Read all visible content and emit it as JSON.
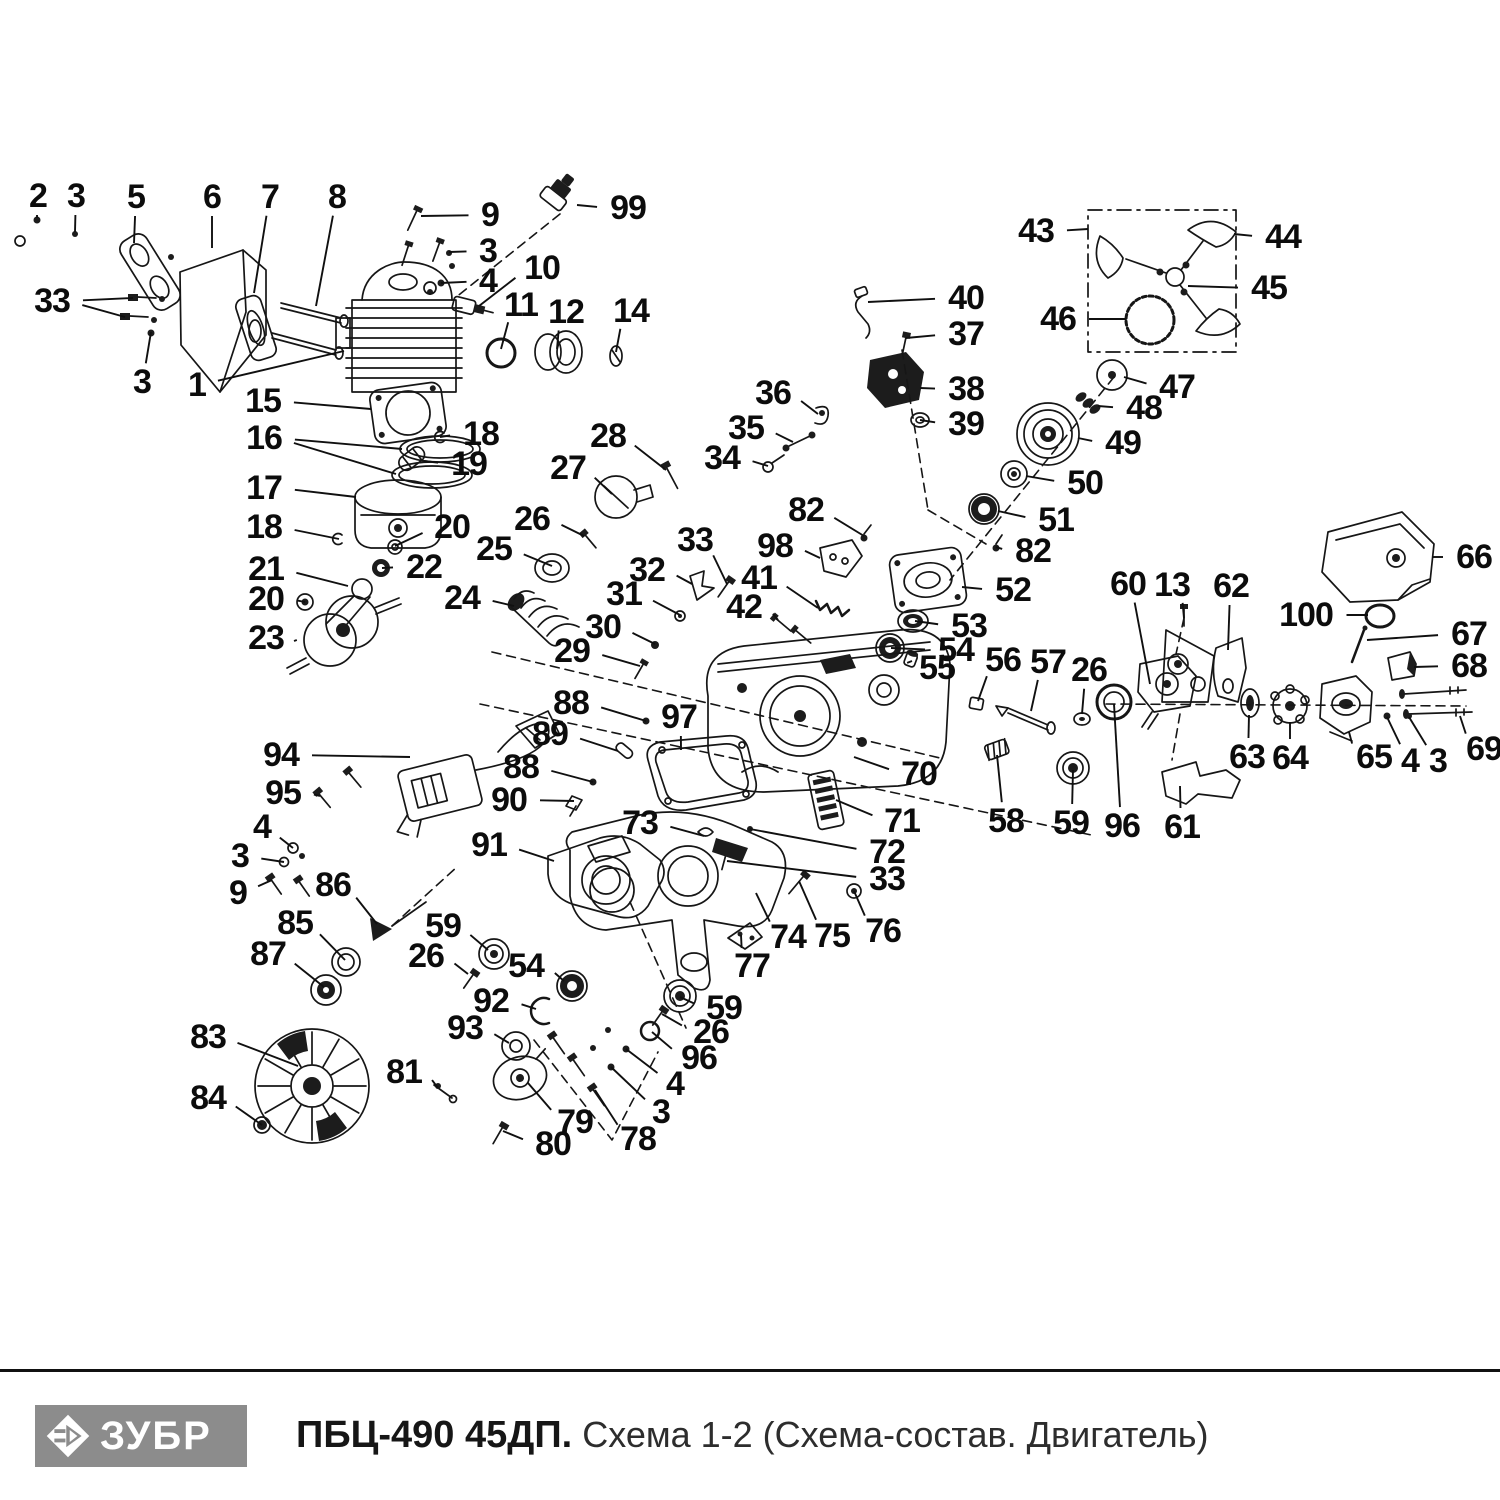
{
  "footer": {
    "brand": "ЗУБР",
    "model": "ПБЦ-490 45ДП.",
    "schema_label": "Схема 1-2 (Схема-состав. Двигатель)"
  },
  "colors": {
    "ink": "#161616",
    "logo_bg": "#8c8c8c",
    "background": "#ffffff"
  },
  "callouts": [
    {
      "n": "2",
      "x": 38,
      "y": 196,
      "t": [
        [
          37,
          218
        ]
      ]
    },
    {
      "n": "3",
      "x": 76,
      "y": 196,
      "t": [
        [
          75,
          232
        ]
      ]
    },
    {
      "n": "5",
      "x": 136,
      "y": 197,
      "t": [
        [
          134,
          243
        ]
      ]
    },
    {
      "n": "6",
      "x": 212,
      "y": 197,
      "t": [
        [
          212,
          248
        ]
      ]
    },
    {
      "n": "7",
      "x": 270,
      "y": 197,
      "t": [
        [
          254,
          293
        ]
      ]
    },
    {
      "n": "8",
      "x": 337,
      "y": 197,
      "t": [
        [
          316,
          306
        ]
      ]
    },
    {
      "n": "9",
      "x": 490,
      "y": 215,
      "t": [
        [
          421,
          216
        ]
      ]
    },
    {
      "n": "99",
      "x": 628,
      "y": 208,
      "t": [
        [
          577,
          205
        ]
      ]
    },
    {
      "n": "3",
      "x": 488,
      "y": 251,
      "t": [
        [
          449,
          252
        ]
      ]
    },
    {
      "n": "4",
      "x": 488,
      "y": 281,
      "t": [
        [
          441,
          283
        ]
      ]
    },
    {
      "n": "10",
      "x": 542,
      "y": 268,
      "t": [
        [
          479,
          306
        ]
      ]
    },
    {
      "n": "11",
      "x": 521,
      "y": 305,
      "t": [
        [
          501,
          349
        ]
      ]
    },
    {
      "n": "12",
      "x": 566,
      "y": 312,
      "t": [
        [
          557,
          349
        ]
      ]
    },
    {
      "n": "14",
      "x": 631,
      "y": 311,
      "t": [
        [
          616,
          352
        ]
      ]
    },
    {
      "n": "33",
      "x": 52,
      "y": 301,
      "t": [
        [
          133,
          298
        ],
        [
          125,
          317
        ]
      ]
    },
    {
      "n": "3",
      "x": 142,
      "y": 382,
      "t": [
        [
          151,
          332
        ]
      ]
    },
    {
      "n": "1",
      "x": 197,
      "y": 385,
      "t": [
        [
          344,
          351
        ]
      ]
    },
    {
      "n": "15",
      "x": 263,
      "y": 401,
      "t": [
        [
          371,
          409
        ]
      ]
    },
    {
      "n": "16",
      "x": 264,
      "y": 438,
      "t": [
        [
          402,
          449
        ],
        [
          396,
          474
        ]
      ]
    },
    {
      "n": "18",
      "x": 481,
      "y": 434,
      "t": [
        [
          440,
          437
        ]
      ]
    },
    {
      "n": "19",
      "x": 469,
      "y": 464,
      "t": [
        [
          424,
          461
        ]
      ]
    },
    {
      "n": "17",
      "x": 264,
      "y": 488,
      "t": [
        [
          356,
          497
        ]
      ]
    },
    {
      "n": "18",
      "x": 264,
      "y": 527,
      "t": [
        [
          339,
          539
        ]
      ]
    },
    {
      "n": "20",
      "x": 452,
      "y": 527,
      "t": [
        [
          395,
          546
        ]
      ]
    },
    {
      "n": "26",
      "x": 532,
      "y": 519,
      "t": [
        [
          584,
          536
        ]
      ]
    },
    {
      "n": "25",
      "x": 494,
      "y": 549,
      "t": [
        [
          552,
          566
        ]
      ]
    },
    {
      "n": "21",
      "x": 266,
      "y": 569,
      "t": [
        [
          348,
          586
        ]
      ]
    },
    {
      "n": "22",
      "x": 424,
      "y": 567,
      "t": [
        [
          382,
          568
        ]
      ]
    },
    {
      "n": "20",
      "x": 266,
      "y": 599,
      "t": [
        [
          305,
          602
        ]
      ]
    },
    {
      "n": "24",
      "x": 462,
      "y": 598,
      "t": [
        [
          514,
          606
        ]
      ]
    },
    {
      "n": "23",
      "x": 266,
      "y": 638,
      "t": [
        [
          294,
          641
        ]
      ]
    },
    {
      "n": "27",
      "x": 568,
      "y": 468,
      "t": [
        [
          612,
          494
        ]
      ]
    },
    {
      "n": "28",
      "x": 608,
      "y": 436,
      "t": [
        [
          666,
          470
        ]
      ]
    },
    {
      "n": "32",
      "x": 647,
      "y": 570,
      "t": [
        [
          692,
          584
        ]
      ]
    },
    {
      "n": "31",
      "x": 624,
      "y": 594,
      "t": [
        [
          680,
          615
        ]
      ]
    },
    {
      "n": "30",
      "x": 603,
      "y": 627,
      "t": [
        [
          655,
          644
        ]
      ]
    },
    {
      "n": "29",
      "x": 572,
      "y": 651,
      "t": [
        [
          640,
          666
        ]
      ]
    },
    {
      "n": "33",
      "x": 695,
      "y": 540,
      "t": [
        [
          727,
          584
        ]
      ]
    },
    {
      "n": "36",
      "x": 773,
      "y": 393,
      "t": [
        [
          818,
          414
        ]
      ]
    },
    {
      "n": "35",
      "x": 746,
      "y": 428,
      "t": [
        [
          793,
          442
        ]
      ]
    },
    {
      "n": "34",
      "x": 722,
      "y": 458,
      "t": [
        [
          768,
          466
        ]
      ]
    },
    {
      "n": "40",
      "x": 966,
      "y": 298,
      "t": [
        [
          868,
          302
        ]
      ]
    },
    {
      "n": "37",
      "x": 966,
      "y": 334,
      "t": [
        [
          906,
          338
        ]
      ]
    },
    {
      "n": "38",
      "x": 966,
      "y": 389,
      "t": [
        [
          920,
          388
        ]
      ]
    },
    {
      "n": "39",
      "x": 966,
      "y": 424,
      "t": [
        [
          920,
          420
        ]
      ]
    },
    {
      "n": "43",
      "x": 1036,
      "y": 231,
      "t": [
        [
          1088,
          229
        ]
      ]
    },
    {
      "n": "44",
      "x": 1283,
      "y": 237,
      "t": [
        [
          1234,
          234
        ]
      ]
    },
    {
      "n": "45",
      "x": 1269,
      "y": 288,
      "t": [
        [
          1188,
          286
        ]
      ]
    },
    {
      "n": "46",
      "x": 1058,
      "y": 319,
      "t": [
        [
          1126,
          319
        ]
      ]
    },
    {
      "n": "47",
      "x": 1177,
      "y": 387,
      "t": [
        [
          1124,
          377
        ]
      ]
    },
    {
      "n": "48",
      "x": 1144,
      "y": 408,
      "t": [
        [
          1098,
          406
        ]
      ]
    },
    {
      "n": "49",
      "x": 1123,
      "y": 443,
      "t": [
        [
          1078,
          438
        ]
      ]
    },
    {
      "n": "50",
      "x": 1085,
      "y": 483,
      "t": [
        [
          1026,
          476
        ]
      ]
    },
    {
      "n": "51",
      "x": 1056,
      "y": 520,
      "t": [
        [
          998,
          511
        ]
      ]
    },
    {
      "n": "82",
      "x": 806,
      "y": 510,
      "t": [
        [
          864,
          536
        ]
      ]
    },
    {
      "n": "82",
      "x": 1033,
      "y": 551,
      "t": [
        [
          996,
          547
        ]
      ]
    },
    {
      "n": "98",
      "x": 775,
      "y": 546,
      "t": [
        [
          820,
          558
        ]
      ]
    },
    {
      "n": "52",
      "x": 1013,
      "y": 590,
      "t": [
        [
          962,
          587
        ]
      ]
    },
    {
      "n": "41",
      "x": 759,
      "y": 578,
      "t": [
        [
          818,
          608
        ]
      ]
    },
    {
      "n": "42",
      "x": 744,
      "y": 607,
      "t": [
        [
          778,
          620
        ]
      ]
    },
    {
      "n": "53",
      "x": 969,
      "y": 626,
      "t": [
        [
          915,
          621
        ]
      ]
    },
    {
      "n": "54",
      "x": 956,
      "y": 650,
      "t": [
        [
          891,
          648
        ]
      ]
    },
    {
      "n": "55",
      "x": 937,
      "y": 668,
      "t": [
        [
          912,
          661
        ]
      ]
    },
    {
      "n": "56",
      "x": 1003,
      "y": 660,
      "t": [
        [
          978,
          701
        ]
      ]
    },
    {
      "n": "57",
      "x": 1048,
      "y": 662,
      "t": [
        [
          1031,
          711
        ]
      ]
    },
    {
      "n": "26",
      "x": 1089,
      "y": 670,
      "t": [
        [
          1082,
          714
        ]
      ]
    },
    {
      "n": "60",
      "x": 1128,
      "y": 584,
      "t": [
        [
          1150,
          684
        ]
      ]
    },
    {
      "n": "13",
      "x": 1172,
      "y": 585,
      "t": [
        [
          1184,
          618
        ]
      ]
    },
    {
      "n": "62",
      "x": 1231,
      "y": 586,
      "t": [
        [
          1228,
          650
        ]
      ]
    },
    {
      "n": "66",
      "x": 1474,
      "y": 557,
      "t": [
        [
          1432,
          557
        ]
      ]
    },
    {
      "n": "100",
      "x": 1306,
      "y": 615,
      "t": [
        [
          1368,
          615
        ]
      ]
    },
    {
      "n": "67",
      "x": 1469,
      "y": 634,
      "t": [
        [
          1367,
          640
        ]
      ]
    },
    {
      "n": "68",
      "x": 1469,
      "y": 666,
      "t": [
        [
          1414,
          667
        ]
      ]
    },
    {
      "n": "63",
      "x": 1247,
      "y": 757,
      "t": [
        [
          1249,
          715
        ]
      ]
    },
    {
      "n": "64",
      "x": 1290,
      "y": 758,
      "t": [
        [
          1290,
          722
        ]
      ]
    },
    {
      "n": "65",
      "x": 1374,
      "y": 757,
      "t": [
        [
          1349,
          732
        ]
      ]
    },
    {
      "n": "4",
      "x": 1410,
      "y": 761,
      "t": [
        [
          1387,
          717
        ]
      ]
    },
    {
      "n": "3",
      "x": 1438,
      "y": 761,
      "t": [
        [
          1409,
          717
        ]
      ]
    },
    {
      "n": "69",
      "x": 1484,
      "y": 749,
      "t": [
        [
          1460,
          716
        ]
      ]
    },
    {
      "n": "96",
      "x": 1122,
      "y": 826,
      "t": [
        [
          1114,
          704
        ]
      ]
    },
    {
      "n": "61",
      "x": 1182,
      "y": 827,
      "t": [
        [
          1180,
          786
        ]
      ]
    },
    {
      "n": "88",
      "x": 571,
      "y": 703,
      "t": [
        [
          646,
          721
        ]
      ]
    },
    {
      "n": "89",
      "x": 550,
      "y": 734,
      "t": [
        [
          618,
          751
        ]
      ]
    },
    {
      "n": "88",
      "x": 521,
      "y": 767,
      "t": [
        [
          593,
          782
        ]
      ]
    },
    {
      "n": "90",
      "x": 509,
      "y": 800,
      "t": [
        [
          574,
          801
        ]
      ]
    },
    {
      "n": "97",
      "x": 679,
      "y": 717,
      "t": [
        [
          681,
          750
        ]
      ]
    },
    {
      "n": "70",
      "x": 919,
      "y": 774,
      "t": [
        [
          854,
          757
        ]
      ]
    },
    {
      "n": "71",
      "x": 902,
      "y": 821,
      "t": [
        [
          836,
          800
        ]
      ]
    },
    {
      "n": "73",
      "x": 640,
      "y": 823,
      "t": [
        [
          704,
          836
        ]
      ]
    },
    {
      "n": "72",
      "x": 887,
      "y": 852,
      "t": [
        [
          750,
          829
        ]
      ]
    },
    {
      "n": "33",
      "x": 887,
      "y": 879,
      "t": [
        [
          727,
          861
        ]
      ]
    },
    {
      "n": "74",
      "x": 788,
      "y": 937,
      "t": [
        [
          756,
          893
        ]
      ]
    },
    {
      "n": "75",
      "x": 832,
      "y": 936,
      "t": [
        [
          799,
          881
        ]
      ]
    },
    {
      "n": "76",
      "x": 883,
      "y": 931,
      "t": [
        [
          854,
          891
        ]
      ]
    },
    {
      "n": "77",
      "x": 752,
      "y": 966,
      "t": [
        [
          741,
          935
        ]
      ]
    },
    {
      "n": "58",
      "x": 1006,
      "y": 821,
      "t": [
        [
          997,
          755
        ]
      ]
    },
    {
      "n": "59",
      "x": 1071,
      "y": 823,
      "t": [
        [
          1073,
          770
        ]
      ]
    },
    {
      "n": "94",
      "x": 281,
      "y": 755,
      "t": [
        [
          410,
          757
        ]
      ]
    },
    {
      "n": "95",
      "x": 283,
      "y": 793,
      "t": [
        [
          320,
          796
        ]
      ]
    },
    {
      "n": "4",
      "x": 262,
      "y": 827,
      "t": [
        [
          293,
          848
        ]
      ]
    },
    {
      "n": "3",
      "x": 240,
      "y": 856,
      "t": [
        [
          284,
          862
        ]
      ]
    },
    {
      "n": "9",
      "x": 238,
      "y": 893,
      "t": [
        [
          272,
          880
        ]
      ]
    },
    {
      "n": "86",
      "x": 333,
      "y": 885,
      "t": [
        [
          377,
          924
        ]
      ]
    },
    {
      "n": "85",
      "x": 295,
      "y": 923,
      "t": [
        [
          345,
          960
        ]
      ]
    },
    {
      "n": "87",
      "x": 268,
      "y": 954,
      "t": [
        [
          324,
          987
        ]
      ]
    },
    {
      "n": "91",
      "x": 489,
      "y": 845,
      "t": [
        [
          554,
          861
        ]
      ]
    },
    {
      "n": "59",
      "x": 443,
      "y": 926,
      "t": [
        [
          488,
          950
        ]
      ]
    },
    {
      "n": "26",
      "x": 426,
      "y": 956,
      "t": [
        [
          468,
          974
        ]
      ]
    },
    {
      "n": "54",
      "x": 526,
      "y": 966,
      "t": [
        [
          564,
          981
        ]
      ]
    },
    {
      "n": "92",
      "x": 491,
      "y": 1001,
      "t": [
        [
          536,
          1009
        ]
      ]
    },
    {
      "n": "93",
      "x": 465,
      "y": 1028,
      "t": [
        [
          509,
          1043
        ]
      ]
    },
    {
      "n": "59",
      "x": 724,
      "y": 1008,
      "t": [
        [
          680,
          997
        ]
      ]
    },
    {
      "n": "26",
      "x": 711,
      "y": 1032,
      "t": [
        [
          662,
          1014
        ]
      ]
    },
    {
      "n": "96",
      "x": 699,
      "y": 1058,
      "t": [
        [
          652,
          1032
        ]
      ]
    },
    {
      "n": "4",
      "x": 675,
      "y": 1084,
      "t": [
        [
          626,
          1049
        ]
      ]
    },
    {
      "n": "3",
      "x": 661,
      "y": 1112,
      "t": [
        [
          611,
          1067
        ]
      ]
    },
    {
      "n": "78",
      "x": 638,
      "y": 1139,
      "t": [
        [
          595,
          1090
        ]
      ]
    },
    {
      "n": "79",
      "x": 575,
      "y": 1122,
      "t": [
        [
          528,
          1083
        ]
      ]
    },
    {
      "n": "80",
      "x": 553,
      "y": 1144,
      "t": [
        [
          503,
          1131
        ]
      ]
    },
    {
      "n": "81",
      "x": 404,
      "y": 1072,
      "t": [
        [
          438,
          1088
        ]
      ]
    },
    {
      "n": "83",
      "x": 208,
      "y": 1037,
      "t": [
        [
          298,
          1066
        ]
      ]
    },
    {
      "n": "84",
      "x": 208,
      "y": 1098,
      "t": [
        [
          262,
          1125
        ]
      ]
    }
  ]
}
